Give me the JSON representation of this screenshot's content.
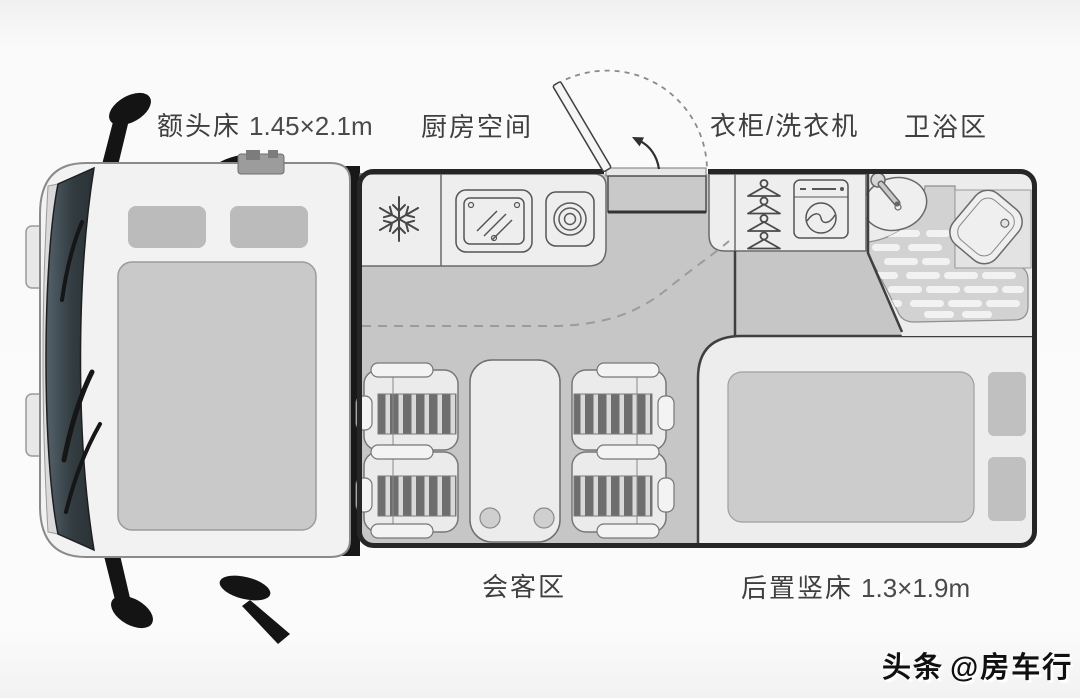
{
  "diagram": {
    "title_context": "RV floor plan (top view)",
    "labels": {
      "overhead_bed": {
        "name": "额头床",
        "size": "1.45×2.1m"
      },
      "kitchen": {
        "name": "厨房空间"
      },
      "wardrobe_washer": {
        "name": "衣柜/洗衣机"
      },
      "bathroom": {
        "name": "卫浴区"
      },
      "lounge": {
        "name": "会客区"
      },
      "rear_bed": {
        "name": "后置竖床",
        "size": "1.3×1.9m"
      }
    },
    "watermark": {
      "source": "头条",
      "handle": "@房车行"
    },
    "icons": {
      "fridge": "snowflake-icon",
      "kitchen_sink": "covered-sink-icon",
      "stove": "burner-rings-icon",
      "wardrobe": "clothes-hangers-icon",
      "washer": "washing-machine-icon",
      "bath_sink": "basin-faucet-icon",
      "toilet": "toilet-icon",
      "shower": "slatted-floor-icon",
      "entry": "door-swing-arc-icon"
    },
    "colors": {
      "floor": "#c6c6c6",
      "fixture_white": "#eeeeee",
      "wall_dark": "#262626",
      "cab_body": "#f2f2f2",
      "windshield": "#39444a",
      "mattress": "#cccccc",
      "label_text": "#3f3f3f"
    }
  }
}
